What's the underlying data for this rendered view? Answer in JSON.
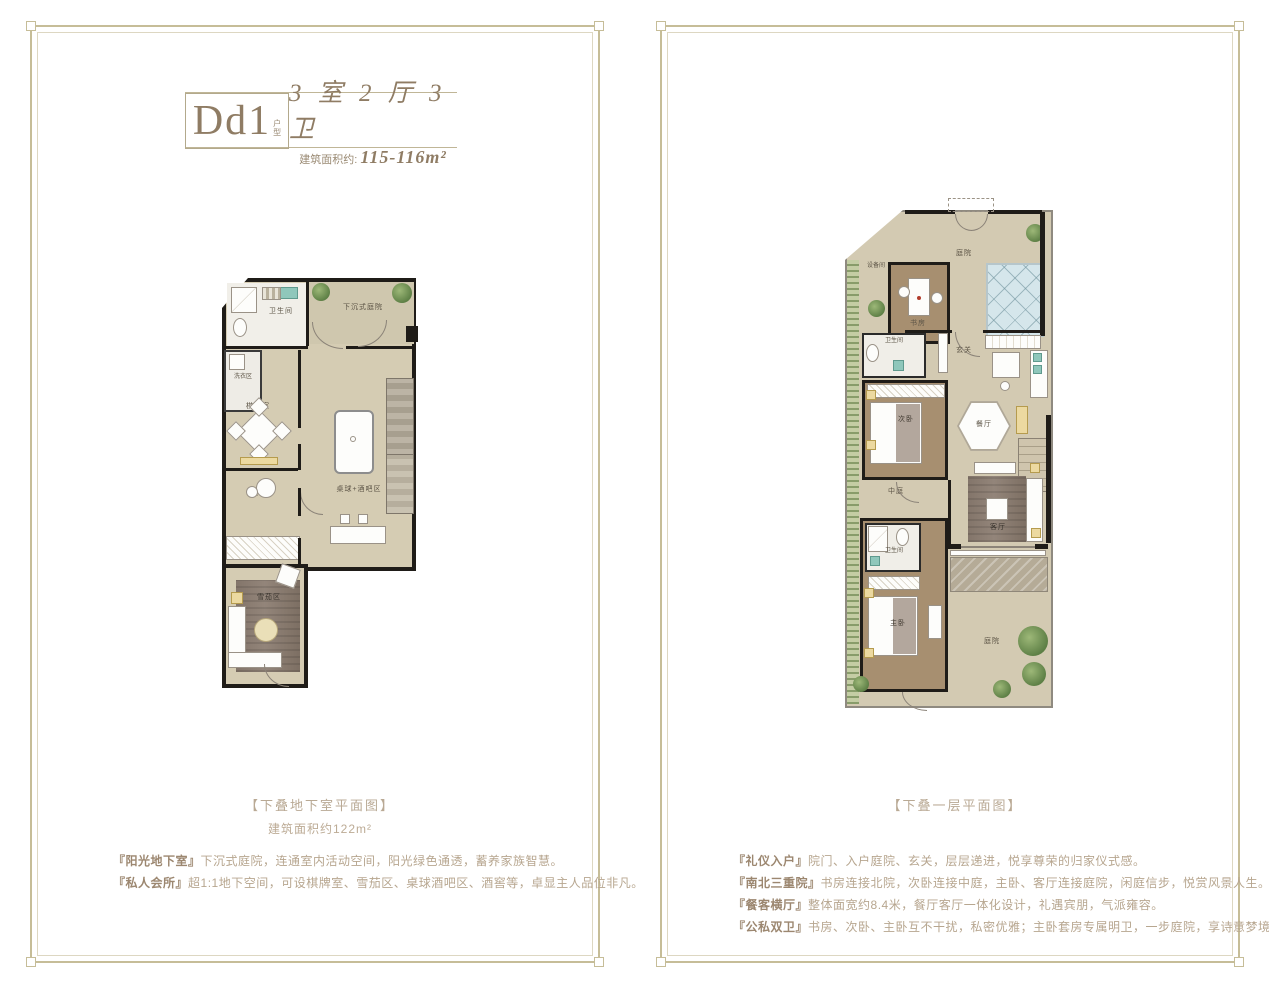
{
  "left_panel": {
    "unit": {
      "code": "Dd1",
      "code_suffix_1": "户",
      "code_suffix_2": "型",
      "spec": "3 室 2 厅 3 卫",
      "area_label": "建筑面积约:",
      "area_value": "115-116m²"
    },
    "caption": "【下叠地下室平面图】",
    "caption_area": "建筑面积约122m²",
    "rooms": {
      "bath": "卫生间",
      "sunken_courtyard": "下沉式庭院",
      "laundry": "洗衣区",
      "games": "棋牌室",
      "cellar": "酒窖",
      "billiards": "桌球+酒吧区",
      "cigar": "雪茄区"
    },
    "descriptions": [
      {
        "label": "『阳光地下室』",
        "text": "下沉式庭院，连通室内活动空间，阳光绿色通透，蓄养家族智慧。"
      },
      {
        "label": "『私人会所』",
        "text": "超1:1地下空间，可设棋牌室、雪茄区、桌球酒吧区、酒窖等，卓显主人品位非凡。"
      }
    ]
  },
  "right_panel": {
    "caption": "【下叠一层平面图】",
    "rooms": {
      "equipment": "设备间",
      "entry_courtyard": "庭院",
      "study": "书房",
      "bath1": "卫生间",
      "foyer": "玄关",
      "bedroom2": "次卧",
      "dining": "餐厅",
      "atrium": "中庭",
      "living": "客厅",
      "bath2": "卫生间",
      "master": "主卧",
      "south_courtyard": "庭院"
    },
    "descriptions": [
      {
        "label": "『礼仪入户』",
        "text": "院门、入户庭院、玄关，层层递进，悦享尊荣的归家仪式感。"
      },
      {
        "label": "『南北三重院』",
        "text": "书房连接北院，次卧连接中庭，主卧、客厅连接庭院，闲庭信步，悦赏风景人生。"
      },
      {
        "label": "『餐客横厅』",
        "text": "整体面宽约8.4米，餐厅客厅一体化设计，礼遇宾朋，气派雍容。"
      },
      {
        "label": "『公私双卫』",
        "text": "书房、次卧、主卧互不干扰，私密优雅；主卧套房专属明卫，一步庭院，享诗意梦境。"
      }
    ]
  },
  "colors": {
    "frame": "#c6bd98",
    "accent_brown": "#8f7c64",
    "caption": "#b9a994",
    "floor_tan": "#d5ccb3",
    "wood": "#a78f70",
    "wall": "#1f1c18",
    "skylight_blue": "#d5e6eb",
    "plant_green": "#6f8f57"
  }
}
